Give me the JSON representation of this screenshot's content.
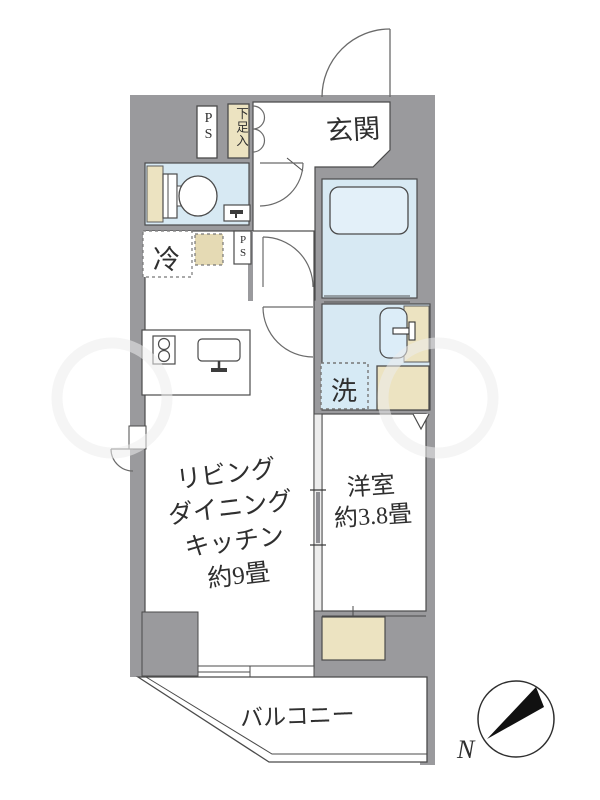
{
  "floor_plan": {
    "entrance": {
      "label": "玄関"
    },
    "pipe_space_top": {
      "label": "PS"
    },
    "shoe_storage": {
      "label": "下足入"
    },
    "refrigerator_space": {
      "label": "冷"
    },
    "pipe_space_mid": {
      "label": "PS"
    },
    "laundry_space": {
      "label": "洗"
    },
    "ldk": {
      "lines": [
        "リビング",
        "ダイニング",
        "キッチン",
        "約9畳"
      ]
    },
    "western_room": {
      "lines": [
        "洋室",
        "約3.8畳"
      ]
    },
    "balcony": {
      "label": "バルコニー"
    },
    "compass": {
      "north_label": "N"
    }
  },
  "colors": {
    "wall_gray": "#9a9a9d",
    "wet_area_blue": "#d7e9f3",
    "fixture_blue": "#dcedf8",
    "storage_beige": "#ece3c1",
    "dashed_beige": "#e5dab4",
    "outline": "#4b4b4b"
  }
}
